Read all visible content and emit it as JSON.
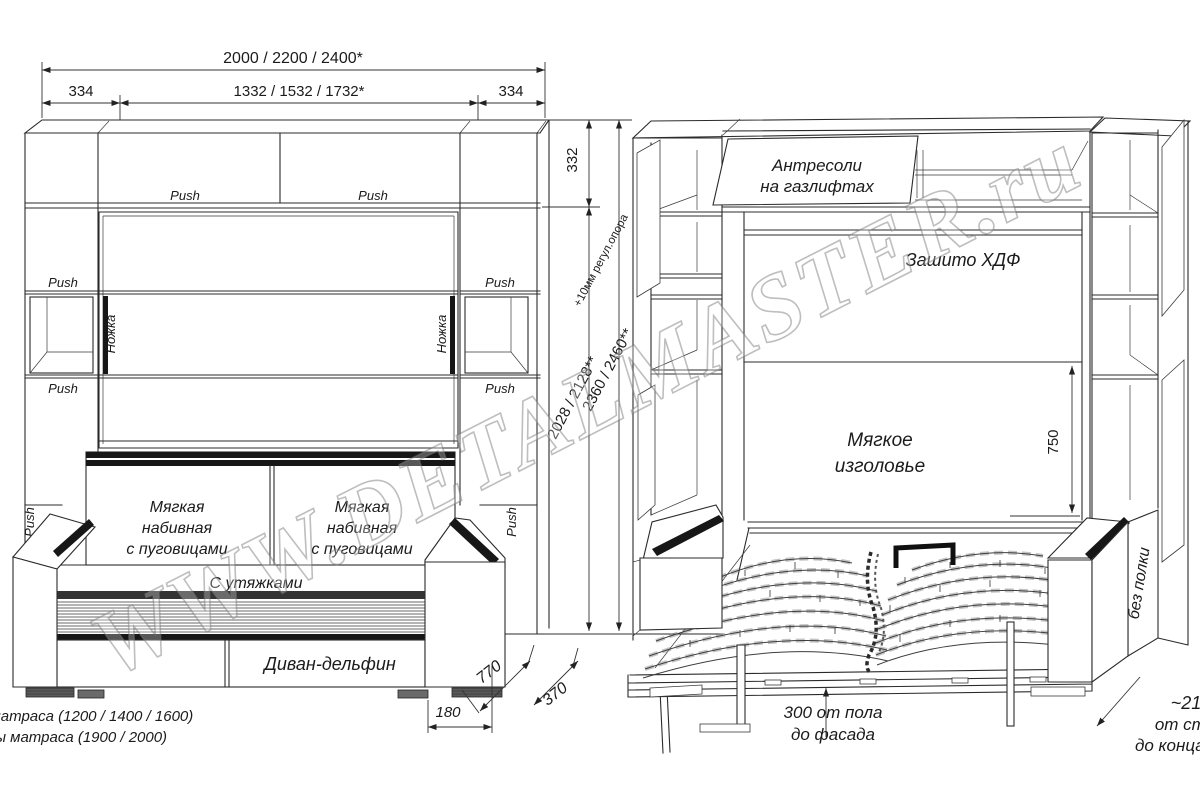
{
  "watermark": {
    "text": "WWW.DETALMASTER.ru"
  },
  "closed_view": {
    "dims": {
      "total_width": "2000 / 2200 / 2400*",
      "side_section_left": "334",
      "center_section": "1332 / 1532 / 1732*",
      "side_section_right": "334",
      "top_section_height": "332",
      "inner_height": "2028 / 2128**",
      "total_height": "2360 / 2460**",
      "height_note": "+10мм регул.опора",
      "sofa_depth": "770",
      "cabinet_depth": "370",
      "base_offset": "180"
    },
    "labels": {
      "push": "Push",
      "leg": "Ножка",
      "cushion_l1": "Мягкая",
      "cushion_l2": "набивная",
      "cushion_l3": "с пуговицами",
      "seat": "С утяжками",
      "sofa_type": "Диван-дельфин"
    }
  },
  "open_view": {
    "dims": {
      "headboard_height": "750"
    },
    "labels": {
      "antresol_l1": "Антресоли",
      "antresol_l2": "на газлифтах",
      "back_panel": "Зашито ХДФ",
      "headboard_l1": "Мягкое",
      "headboard_l2": "изголовье",
      "no_shelf": "без полки",
      "floor_l1": "300 от пола",
      "floor_l2": "до фасада",
      "wall_l1": "~2100",
      "wall_l2": "от стены",
      "wall_l3": "до конца ножек"
    }
  },
  "footnotes": {
    "width": "* зависит от ширины матраса (1200 / 1400 / 1600)",
    "length": "** зависит от длины матраса (1900 / 2000)"
  }
}
